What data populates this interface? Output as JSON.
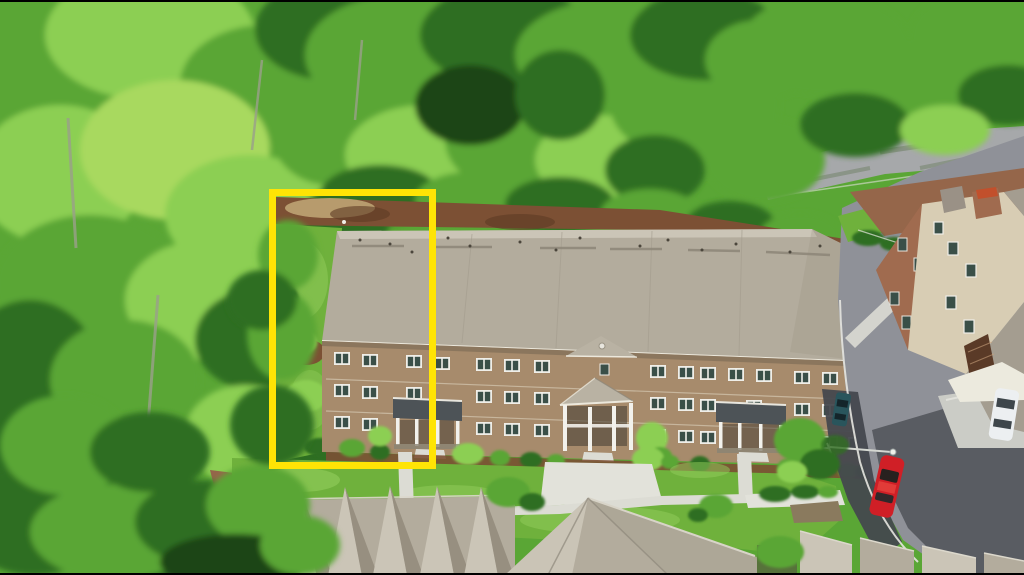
{
  "scene": {
    "type": "aerial-drone-photo",
    "description": "Aerial view of a three-story brick townhome building in a wooded community; the left end unit and its side yard are outlined with a yellow rectangle; street with parked cars on the right, rooftops in the foreground, dense green trees around."
  },
  "highlight": {
    "shape": "rectangle",
    "color": "#ffe405"
  },
  "colors": {
    "highlight": "#ffe405",
    "forest_light": "#8ccf52",
    "forest_mid": "#5aa635",
    "forest_dark": "#2f6e22",
    "forest_deep": "#1c4517",
    "canopy_lime": "#a8d95e",
    "trunk": "#9aa08b",
    "roof_light": "#cbc5b7",
    "roof_mid": "#b3ac9d",
    "roof_dark": "#978f80",
    "brick": "#a78b6c",
    "brick_dark": "#8d7257",
    "window_glass": "#3a4f48",
    "window_trim": "#efeee8",
    "porch_roof": "#4d5357",
    "porch_white": "#f2f1ec",
    "pediment": "#b9b2a3",
    "lawn": "#6fb13c",
    "lawn_light": "#93cd5c",
    "mulch": "#7c5034",
    "mulch_light": "#95664a",
    "concrete": "#dcdcd4",
    "road": "#8f9198",
    "road_dark": "#53565c",
    "asphalt_new": "#45484e",
    "curb": "#e6e6e0",
    "car_red": "#d01f26",
    "car_teal": "#29555c",
    "car_white": "#eceff1",
    "rb_brick": "#a06b4f",
    "rb_siding": "#d8cdb4",
    "rb_roof": "#a49d90",
    "chimney_cap": "#c2502c",
    "letterbox": "#000000"
  }
}
